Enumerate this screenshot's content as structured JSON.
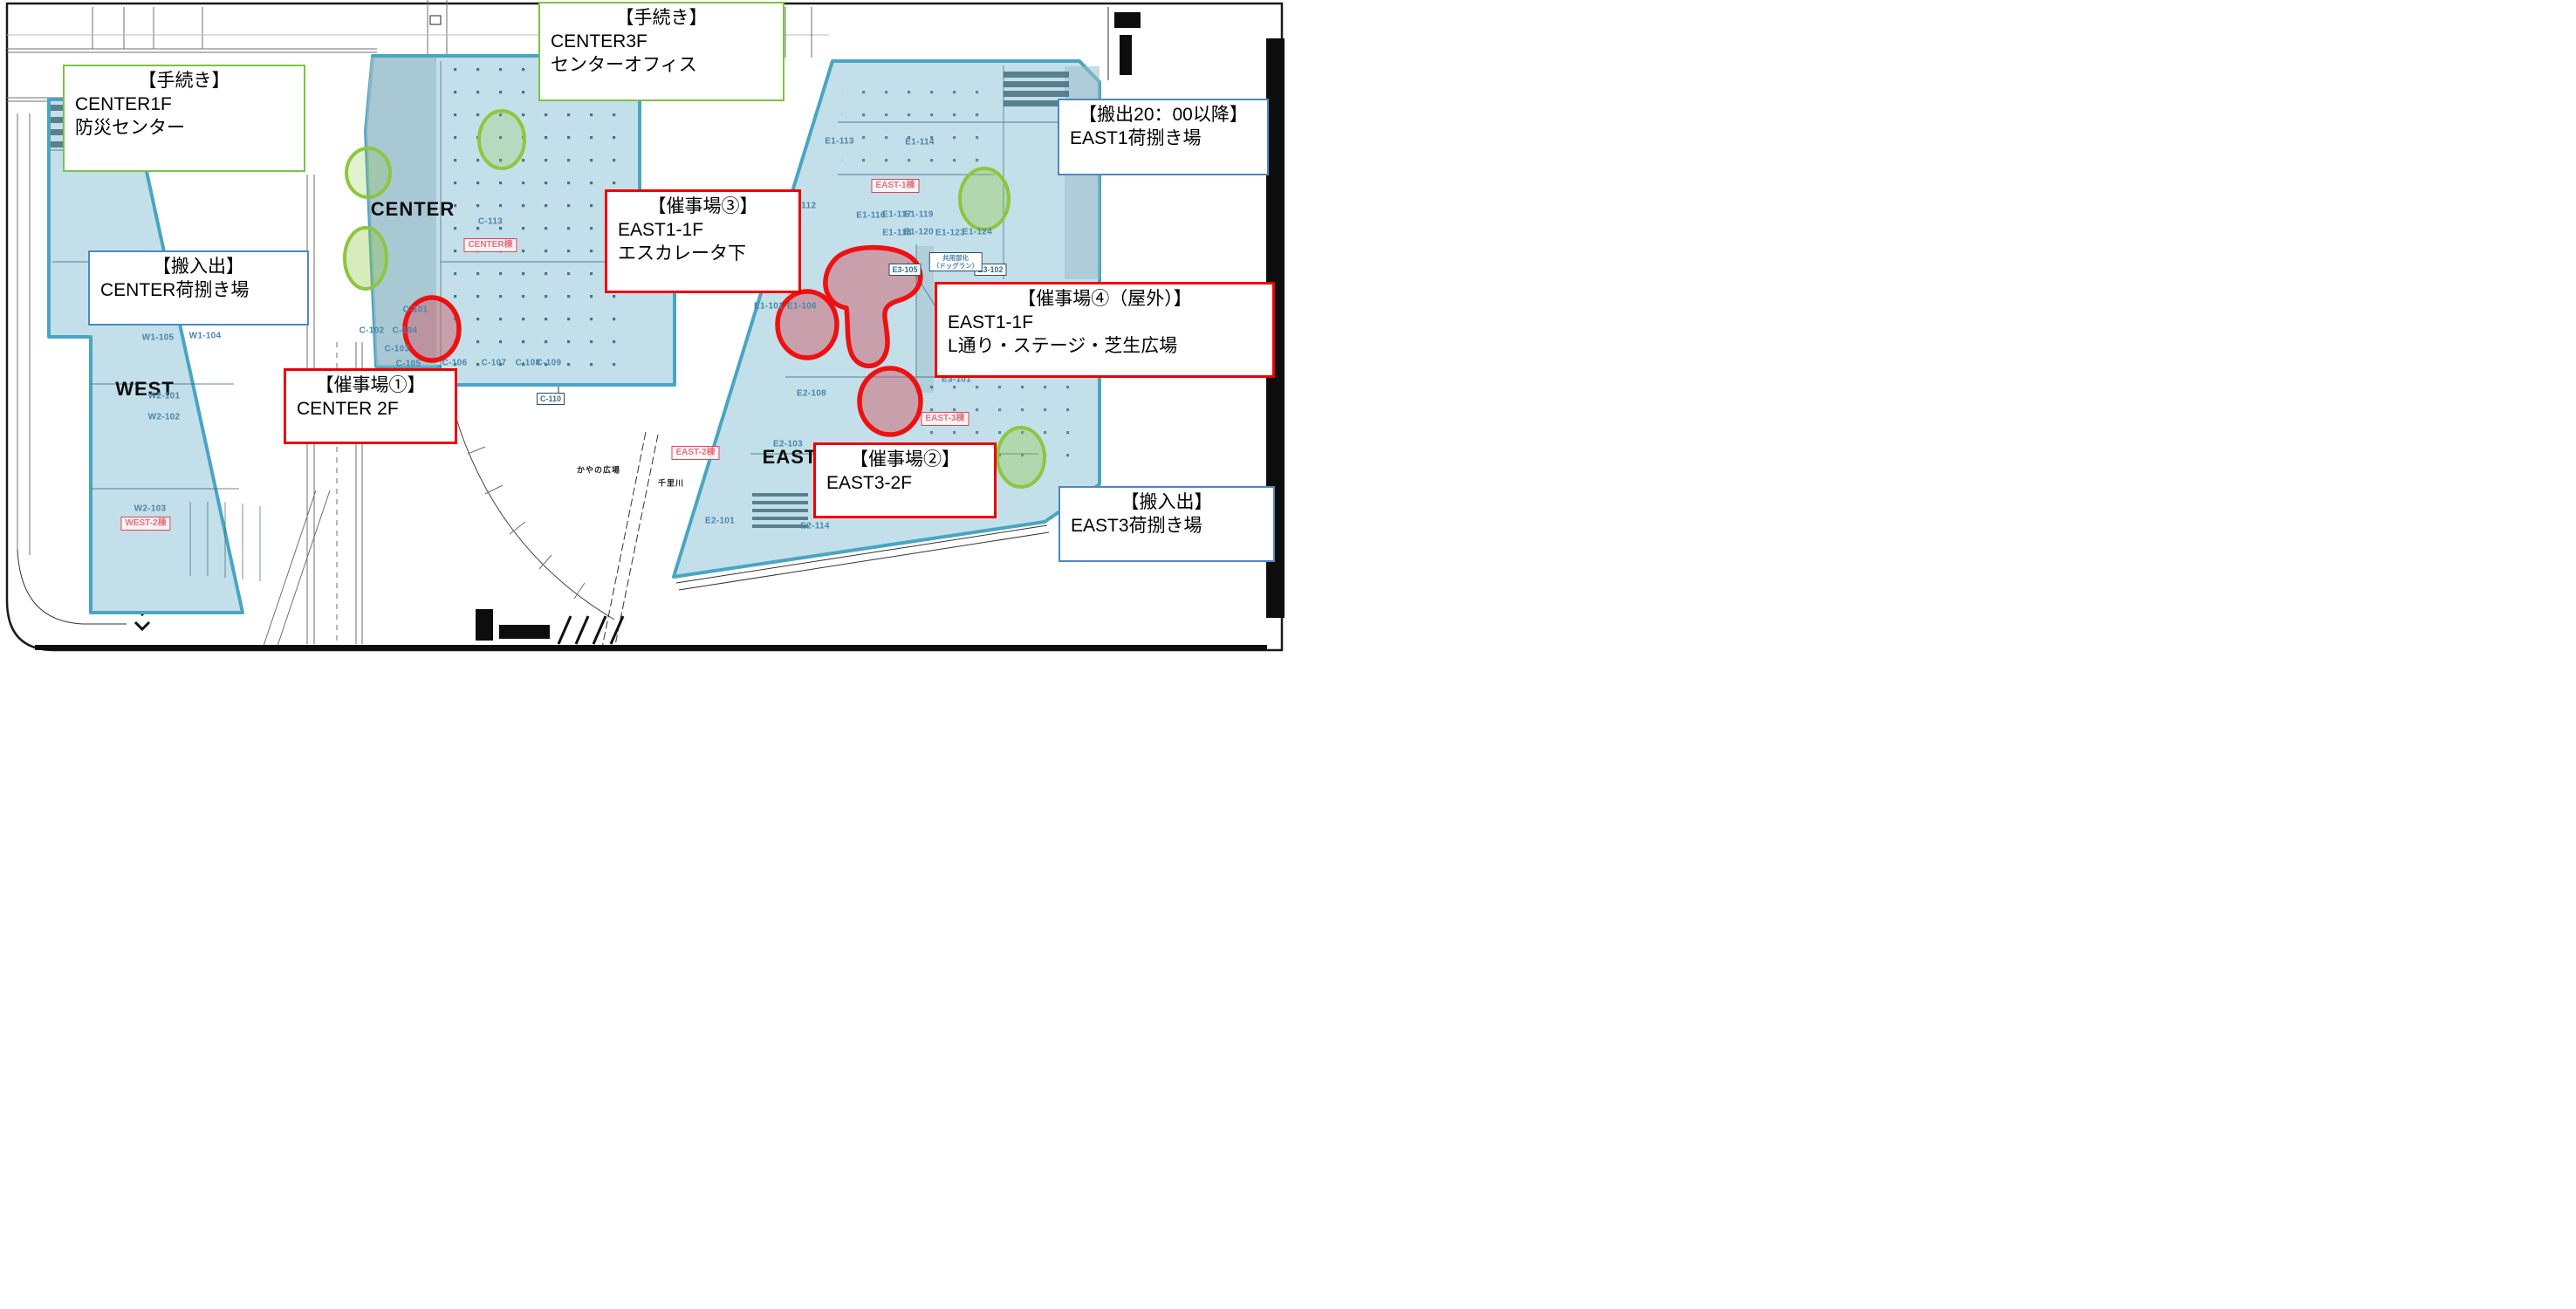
{
  "buildings": {
    "west": "WEST",
    "center": "CENTER",
    "east": "EAST"
  },
  "tags": {
    "center": "CENTER棟",
    "east1": "EAST-1棟",
    "east2": "EAST-2棟",
    "east3": "EAST-3棟",
    "west2": "WEST-2棟"
  },
  "rooms": {
    "c101": "C-101",
    "c102": "C-102",
    "c103": "C-103",
    "c104": "C-104",
    "c105": "C-105",
    "c106": "C-106",
    "c107": "C-107",
    "c108": "C-108",
    "c109": "C-109",
    "c110": "C-110",
    "c113": "C-113",
    "w1_101": "W1-101",
    "w1_104": "W1-104",
    "w1_105": "W1-105",
    "w2_101": "W2-101",
    "w2_102": "W2-102",
    "w2_103": "W2-103",
    "e1_112": "-112",
    "e1_113": "E1-113",
    "e1_114": "E1-114",
    "e1_116": "E1-116",
    "e1_117": "E1-117",
    "e1_118": "E1-118",
    "e1_119": "E1-119",
    "e1_120": "E1-120",
    "e1_123": "E1-123",
    "e1_124": "E1-124",
    "e1_101": "E1-101",
    "e1_106": "E1-106",
    "e2_101": "E2-101",
    "e2_103": "E2-103",
    "e2_108": "E2-108",
    "e2_114": "E2-114",
    "e3_101": "E3-101",
    "e3_102": "E3-102",
    "e3_105": "E3-105"
  },
  "labels": {
    "kayano_hiroba": "かやの広場",
    "senri_river": "千里川",
    "dogrun_line1": "共用部化",
    "dogrun_line2": "（ドッグラン）"
  },
  "callouts": {
    "procedure_center1f": {
      "title": "【手続き】",
      "line1": "CENTER1F",
      "line2": "防災センター"
    },
    "procedure_center3f": {
      "title": "【手続き】",
      "line1": "CENTER3F",
      "line2": "センターオフィス"
    },
    "carryout_east1": {
      "title": "【搬出20：00以降】",
      "line1": "EAST1荷捌き場"
    },
    "carryinout_center": {
      "title": "【搬入出】",
      "line1": "CENTER荷捌き場"
    },
    "venue1": {
      "title": "【催事場①】",
      "line1": "CENTER 2F"
    },
    "venue2": {
      "title": "【催事場②】",
      "line1": "EAST3-2F"
    },
    "venue3": {
      "title": "【催事場③】",
      "line1": "EAST1-1F",
      "line2": "エスカレータ下"
    },
    "venue4": {
      "title": "【催事場④（屋外）】",
      "line1": "EAST1-1F",
      "line2": "L通り・ステージ・芝生広場"
    },
    "carryinout_east3": {
      "title": "【搬入出】",
      "line1": "EAST3荷捌き場"
    }
  },
  "colors": {
    "building_fill": "#c3e0ea",
    "building_border": "#4aa5c2",
    "marker_green": "#8dc63f",
    "marker_red": "#ee1111",
    "marker_red_fill": "#d2737f",
    "callout_green_border": "#7dc242",
    "callout_blue_border": "#4e87c8",
    "callout_red_border": "#ee0000",
    "room_label_blue": "#4b84aa",
    "tenant_tag_red": "#e04350"
  }
}
